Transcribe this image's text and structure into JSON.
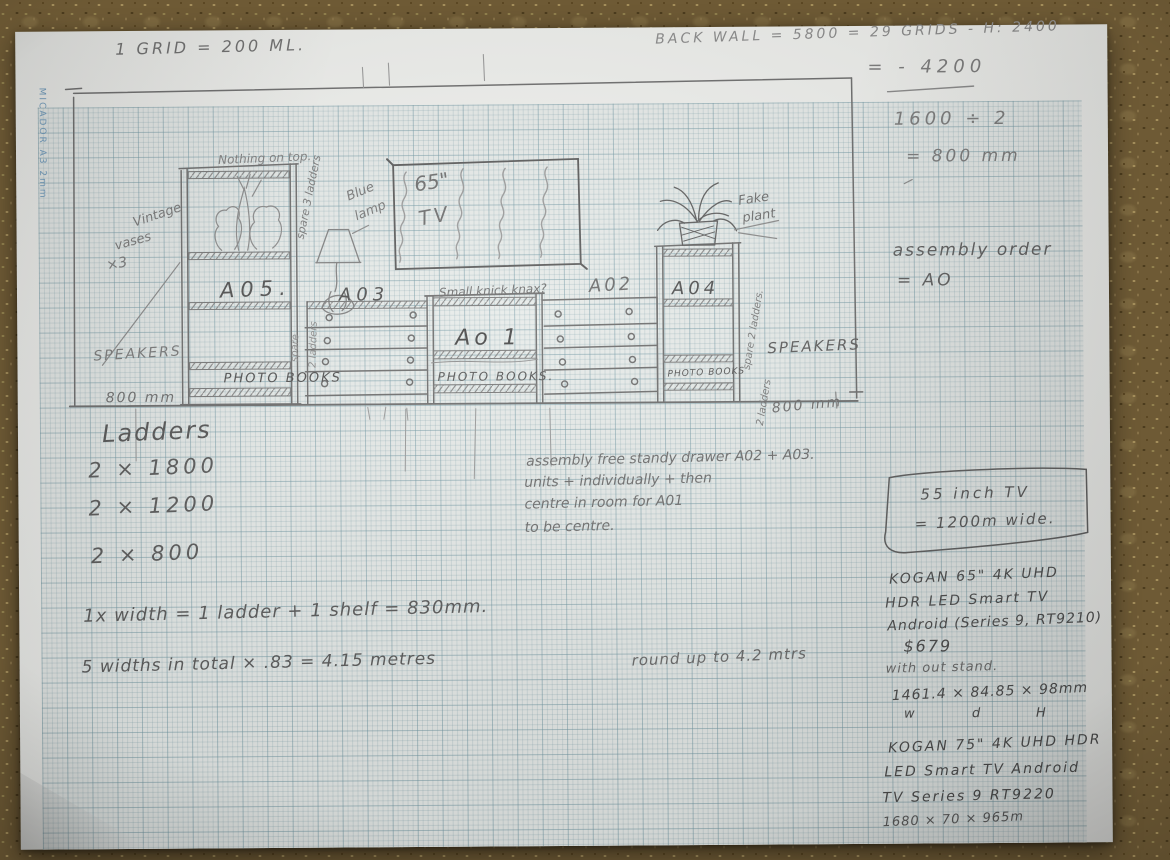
{
  "paper": {
    "edge_brand": "MICADOR A3 2mm"
  },
  "header": {
    "grid_scale": "1 GRID = 200 ML.",
    "back_wall": "BACK WALL = 5800 = 29 GRIDS - H: 2400"
  },
  "calcs": {
    "minus_calc": "= - 4200",
    "divide_calc": "1600 ÷ 2",
    "result": "= 800 mm",
    "assembly_order_label": "assembly order",
    "assembly_order_value": "= AO"
  },
  "drawing": {
    "labels": {
      "nothing_on_top": "Nothing on top.",
      "vintage_vases_1": "Vintage",
      "vintage_vases_2": "vases",
      "vintage_vases_3": "×3",
      "spare_3_ladders": "spare 3 ladders",
      "spare_left": "spare",
      "two_ladders_left": "2 ladders",
      "blue_lamp_1": "Blue",
      "blue_lamp_2": "lamp",
      "unit_a05": "A05.",
      "unit_a03": "A03",
      "unit_a01": "Ao 1",
      "unit_a02": "A02",
      "unit_a04": "A04",
      "small_knick_knax": "Small knick knax?",
      "tv_size": "65\"",
      "tv": "TV",
      "fake_plant_1": "Fake",
      "fake_plant_2": "plant",
      "spare_2_ladders_a": "spare 2 ladders.",
      "spare_2_ladders_b": "2 ladders",
      "speakers_left": "SPEAKERS",
      "speakers_right": "SPEAKERS",
      "photo_books_a05": "PHOTO BOOKS",
      "photo_books_a01": "PHOTO BOOKS.",
      "photo_books_a04": "PHOTO BOOKS",
      "dim_left": "800 mm",
      "dim_right": "800 mm"
    }
  },
  "ladder_notes": {
    "heading": "Ladders",
    "items": [
      "2 × 1800",
      "2 × 1200",
      "2 × 800"
    ]
  },
  "width_notes": {
    "width_formula": "1x width = 1 ladder + 1 shelf = 830mm.",
    "total_formula": "5 widths in total × .83 = 4.15 metres",
    "round_up": "round up to 4.2 mtrs"
  },
  "assembly_note": {
    "line1": "assembly free standy drawer A02 + A03.",
    "line2": "units + individually + then",
    "line3": "centre in room for A01",
    "line4": "to be centre."
  },
  "tv_notes": {
    "box_line1": "55 inch TV",
    "box_line2": "= 1200m wide.",
    "kogan65_line1": "KOGAN 65\" 4K UHD",
    "kogan65_line2": "HDR LED Smart TV",
    "kogan65_line3": "Android (Series 9, RT9210)",
    "price": "$679",
    "no_stand": "with out stand.",
    "dims65": "1461.4 × 84.85 × 98mm",
    "axis_w": "w",
    "axis_d": "d",
    "axis_h": "H",
    "kogan75_line1": "KOGAN 75\" 4K UHD HDR",
    "kogan75_line2": "LED Smart TV Android",
    "kogan75_line3": "TV Series 9 RT9220",
    "dims75": "1680 × 70 × 965m"
  }
}
